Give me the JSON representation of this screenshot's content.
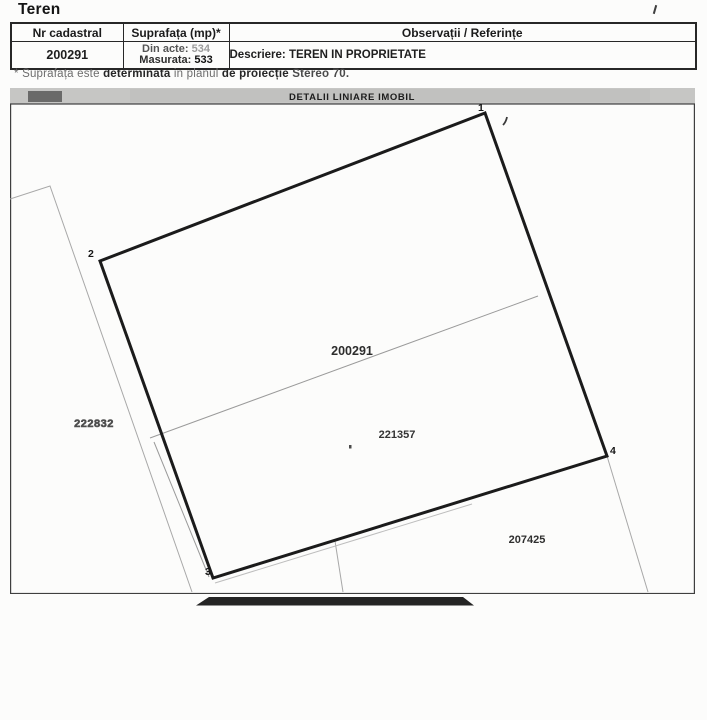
{
  "page": {
    "title": "Teren"
  },
  "table": {
    "headers": [
      "Nr cadastral",
      "Suprafața (mp)*",
      "Observații / Referințe"
    ],
    "row": {
      "nr_cadastral": "200291",
      "suprafata_lines": [
        {
          "label": "Din acte:",
          "value": "534"
        },
        {
          "label": "Masurata:",
          "value": "533"
        }
      ],
      "observatii": "Descriere: TEREN IN PROPRIETATE"
    }
  },
  "footnote": {
    "parts": [
      "* Suprafața este ",
      "determinată",
      " in planul ",
      "de proiecție ",
      "Stereo 70."
    ]
  },
  "plan": {
    "title": "DETALII LINIARE IMOBIL",
    "parcel_labels": {
      "main": "200291",
      "sub": "221357",
      "neighbor_left": "222832",
      "neighbor_bottom_right": "207425"
    },
    "vertex_labels": [
      "1",
      "2",
      "3",
      "4"
    ],
    "colors": {
      "boundary": "#1b1b1b",
      "neighbor_line": "#a8a8a8",
      "title_bar_bg": "#c6c6c4",
      "redaction_bar": "#242424"
    }
  }
}
